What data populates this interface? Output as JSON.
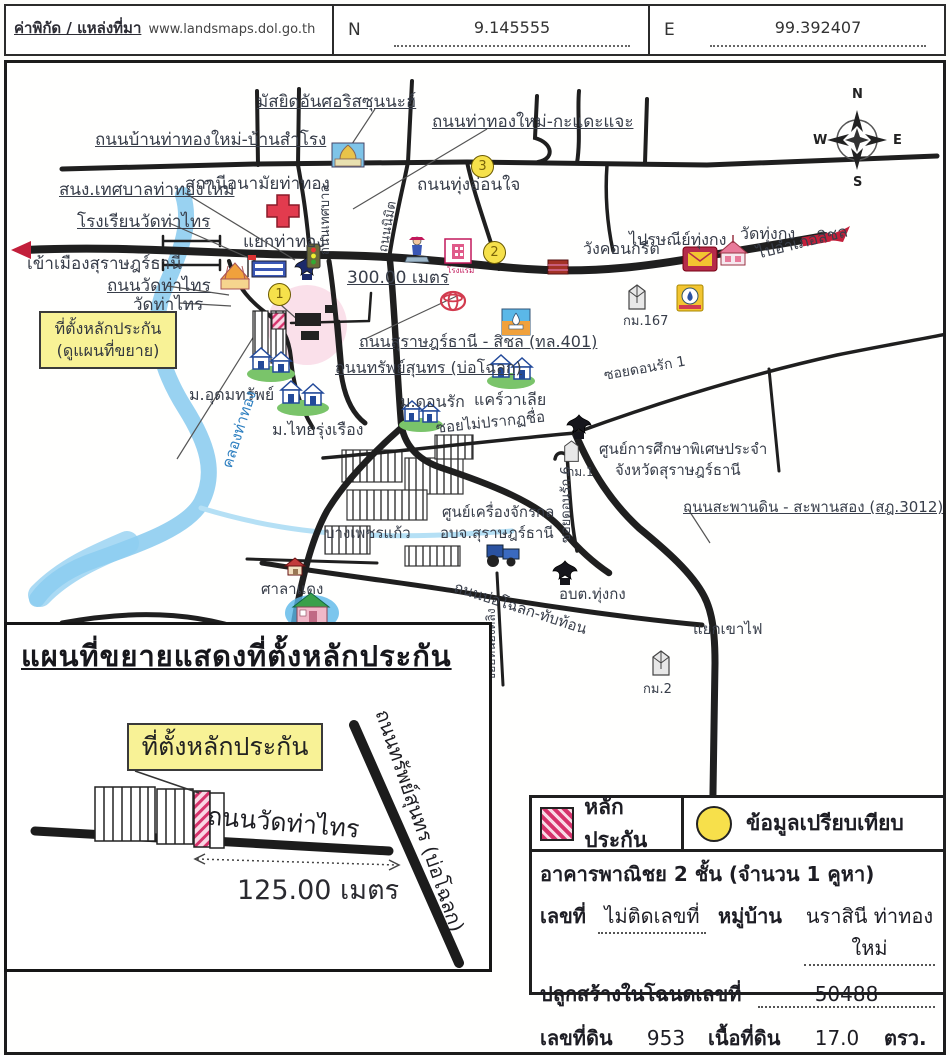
{
  "header": {
    "source_label": "ค่าพิกัด / แหล่งที่มา",
    "source_url": "www.landsmaps.dol.go.th",
    "n_label": "N",
    "n_value": "9.145555",
    "e_label": "E",
    "e_value": "99.392407"
  },
  "compass": {
    "n": "N",
    "s": "S",
    "e": "E",
    "w": "W"
  },
  "collateral_box": {
    "line1": "ที่ตั้งหลักประกัน",
    "line2": "(ดูแผนที่ขยาย)"
  },
  "map": {
    "labels": [
      {
        "id": "label-mosque",
        "text": "มัสยิดอันศอริสซุนนะฮ์",
        "x": 250,
        "y": 30,
        "fs": 17,
        "u": 1
      },
      {
        "id": "label-road-banthathong",
        "text": "ถนนบ้านท่าทองใหม่-บ้านสำโรง",
        "x": 88,
        "y": 68,
        "fs": 17,
        "u": 1
      },
      {
        "id": "label-road-kadaejae",
        "text": "ถนนท่าทองใหม่-กะแดะแจะ",
        "x": 425,
        "y": 50,
        "fs": 17,
        "u": 1
      },
      {
        "id": "label-thesaban-office",
        "text": "สนง.เทศบาลท่าทองใหม่",
        "x": 52,
        "y": 118,
        "fs": 17,
        "u": 1
      },
      {
        "id": "label-health-station",
        "text": "สถานีอนามัยท่าทอง",
        "x": 178,
        "y": 112,
        "fs": 17
      },
      {
        "id": "label-school-watthasai",
        "text": "โรงเรียนวัดท่าไทร",
        "x": 70,
        "y": 150,
        "fs": 17,
        "u": 1
      },
      {
        "id": "label-yaek-thathong",
        "text": "แยกท่าทอง",
        "x": 236,
        "y": 170,
        "fs": 17
      },
      {
        "id": "label-road-thungonjai",
        "text": "ถนนทุ่งอ่อนใจ",
        "x": 410,
        "y": 113,
        "fs": 17
      },
      {
        "id": "label-enter-surat",
        "text": "เข้าเมืองสุราษฎร์ธานี",
        "x": 20,
        "y": 192,
        "fs": 17
      },
      {
        "id": "label-road-watthasai",
        "text": "ถนนวัดท่าไทร",
        "x": 100,
        "y": 214,
        "fs": 17,
        "u": 1
      },
      {
        "id": "label-wat-thasai",
        "text": "วัดท่าไทร",
        "x": 126,
        "y": 233,
        "fs": 17
      },
      {
        "id": "label-300m",
        "text": "300.00 เมตร",
        "x": 340,
        "y": 206,
        "fs": 17,
        "u": 1
      },
      {
        "id": "label-post-thungkong",
        "text": "ไปรษณีย์ทุ่งกง",
        "x": 622,
        "y": 168,
        "fs": 16
      },
      {
        "id": "label-wat-thungkong",
        "text": "วัดทุ่งกง",
        "x": 733,
        "y": 162,
        "fs": 16
      },
      {
        "id": "label-to-sichon",
        "text": "ไปอำเภอสิชล",
        "x": 748,
        "y": 182,
        "fs": 16,
        "rot": -14
      },
      {
        "id": "label-wang-concrete",
        "text": "วังคอนกรีต",
        "x": 576,
        "y": 177,
        "fs": 16
      },
      {
        "id": "label-km167",
        "text": "กม.167",
        "x": 616,
        "y": 252,
        "fs": 13
      },
      {
        "id": "label-road-401",
        "text": "ถนนสุราษฎร์ธานี - สิชล (ทล.401)",
        "x": 352,
        "y": 270,
        "fs": 16,
        "u": 1
      },
      {
        "id": "label-road-sapsunthon",
        "text": "ถนนทรัพย์สุนทร (บ่อโฉลก)",
        "x": 328,
        "y": 296,
        "fs": 16,
        "u": 1
      },
      {
        "id": "label-mu-udomsap",
        "text": "ม.อุดมทรัพย์",
        "x": 182,
        "y": 323,
        "fs": 16
      },
      {
        "id": "label-mu-thairungruang",
        "text": "ม.ไทยรุ่งเรือง",
        "x": 265,
        "y": 358,
        "fs": 16
      },
      {
        "id": "label-mu-donrak",
        "text": "ม.ดอนรัก",
        "x": 393,
        "y": 330,
        "fs": 16
      },
      {
        "id": "label-carevalia",
        "text": "แคร์วาเลีย",
        "x": 467,
        "y": 328,
        "fs": 16
      },
      {
        "id": "label-soi-donrak1",
        "text": "ซอยดอนรัก 1",
        "x": 596,
        "y": 306,
        "fs": 14,
        "rot": -10
      },
      {
        "id": "label-soi-unnamed",
        "text": "ซอยไม่ปรากฏชื่อ",
        "x": 428,
        "y": 357,
        "fs": 15,
        "rot": -6
      },
      {
        "id": "label-special-edu1",
        "text": "ศูนย์การศึกษาพิเศษประจำ",
        "x": 592,
        "y": 378,
        "fs": 15
      },
      {
        "id": "label-special-edu2",
        "text": "จังหวัดสุราษฎร์ธานี",
        "x": 608,
        "y": 399,
        "fs": 15
      },
      {
        "id": "label-km1",
        "text": "กม.1",
        "x": 560,
        "y": 403,
        "fs": 12
      },
      {
        "id": "label-road-saphandin",
        "text": "ถนนสะพานดิน - สะพานสอง (สฎ.3012)",
        "x": 676,
        "y": 436,
        "fs": 15,
        "u": 1
      },
      {
        "id": "label-khlong-thathong",
        "text": "คลองท่าทอง",
        "x": 212,
        "y": 402,
        "fs": 15,
        "rot": -72,
        "color": "#2d7fc0"
      },
      {
        "id": "label-bang-phetkaew",
        "text": "บางเพชรแก้ว",
        "x": 318,
        "y": 462,
        "fs": 15
      },
      {
        "id": "label-machinery1",
        "text": "ศูนย์เครื่องจักรกล",
        "x": 435,
        "y": 441,
        "fs": 15
      },
      {
        "id": "label-machinery2",
        "text": "อบจ.สุราษฎร์ธานี",
        "x": 433,
        "y": 462,
        "fs": 15
      },
      {
        "id": "label-soi-donrak6",
        "text": "ซอยดอนรัก 6",
        "x": 553,
        "y": 480,
        "fs": 13,
        "rot": -90
      },
      {
        "id": "label-obt-thungkong",
        "text": "อบต.ทุ่งกง",
        "x": 552,
        "y": 523,
        "fs": 15
      },
      {
        "id": "label-road-bocholok",
        "text": "ถนนบ่อโฉลก-ทับท้อน",
        "x": 450,
        "y": 516,
        "fs": 15,
        "rot": 18
      },
      {
        "id": "label-yaek-khaofai",
        "text": "แยกเขาไฟ",
        "x": 686,
        "y": 558,
        "fs": 15
      },
      {
        "id": "label-km2",
        "text": "กม.2",
        "x": 636,
        "y": 620,
        "fs": 13
      },
      {
        "id": "label-saladaeng",
        "text": "ศาลาแดง",
        "x": 254,
        "y": 518,
        "fs": 15
      },
      {
        "id": "label-monkey-college",
        "text": "วิทยาลัยฝึกลิง",
        "x": 282,
        "y": 570,
        "fs": 16
      },
      {
        "id": "label-soi-nongtaling",
        "text": "ซอยหนองตลิง",
        "x": 478,
        "y": 618,
        "fs": 12,
        "rot": -90
      },
      {
        "id": "label-road-thesaban",
        "text": "ถนนเทศบาล",
        "x": 312,
        "y": 192,
        "fs": 13,
        "rot": -90
      },
      {
        "id": "label-road-nimit",
        "text": "ถนนนิมิต",
        "x": 370,
        "y": 188,
        "fs": 13,
        "rot": -80
      },
      {
        "id": "label-hotel-caption",
        "text": "โรงแรม",
        "x": 440,
        "y": 204,
        "fs": 8,
        "color": "#c2185b"
      }
    ],
    "markers": [
      {
        "id": "marker-1",
        "n": "1",
        "x": 261,
        "y": 220
      },
      {
        "id": "marker-2",
        "n": "2",
        "x": 476,
        "y": 178
      },
      {
        "id": "marker-3",
        "n": "3",
        "x": 464,
        "y": 92
      }
    ]
  },
  "inset": {
    "title": "แผนที่ขยายแสดงที่ตั้งหลักประกัน",
    "collateral_label": "ที่ตั้งหลักประกัน",
    "road_label": "ถนนวัดท่าไทร",
    "distance": "125.00 เมตร",
    "diagonal_road_label": "ถนนทรัพย์สุนทร (บ่อโฉลก)"
  },
  "legend": {
    "collateral": "หลักประกัน",
    "comparison": "ข้อมูลเปรียบเทียบ",
    "building": "อาคารพาณิชย 2 ชั้น (จำนวน 1 คูหา)",
    "house_no_label": "เลขที่",
    "house_no": "ไม่ติดเลขที่",
    "village_label": "หมู่บ้าน",
    "village": "นราสินี ท่าทองใหม่",
    "deed_label": "ปลูกสร้างในโฉนดเลขที่",
    "deed_no": "50488",
    "parcel_label": "เลขที่ดิน",
    "parcel_no": "953",
    "area_label": "เนื้อที่ดิน",
    "area": "17.0",
    "area_unit": "ตรว."
  },
  "colors": {
    "road": "#1f1f1f",
    "river": "#8ecdf0",
    "marker_fill": "#f6e14b",
    "halo_pink": "#f3bad2",
    "collateral_hatch": "#d6336c",
    "callout_yellow": "#f8f296"
  }
}
